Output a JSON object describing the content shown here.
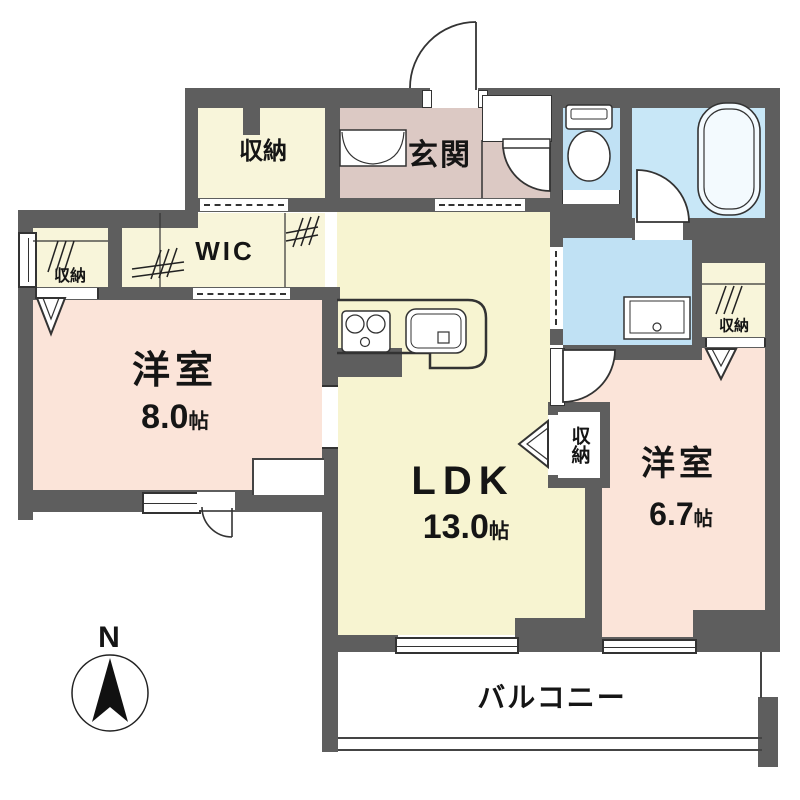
{
  "plan": {
    "type": "apartment-floor-plan",
    "rooms": {
      "closet_top": {
        "label": "収納"
      },
      "wic": {
        "label": "WIC"
      },
      "closet_left": {
        "label": "収納"
      },
      "western8": {
        "label": "洋室",
        "size": "8.0",
        "unit": "帖"
      },
      "genkan": {
        "label": "玄関"
      },
      "ldk": {
        "label": "LDK",
        "size": "13.0",
        "unit": "帖"
      },
      "closet_mid": {
        "label": "収納"
      },
      "western67": {
        "label": "洋室",
        "size": "6.7",
        "unit": "帖"
      },
      "closet_right": {
        "label": "収納"
      },
      "balcony": {
        "label": "バルコニー"
      }
    },
    "fixtures": [
      "toilet",
      "bathtub",
      "vanity",
      "stove",
      "kitchen-sink",
      "shoe-cabinet"
    ],
    "compass": {
      "north_label": "N"
    },
    "colors": {
      "wall": "#5e5e5e",
      "ldk_yellow": "#f7f4d1",
      "closet_cream": "#f8f5da",
      "room_pink": "#fbe4d9",
      "genkan_pink": "#dcc9c4",
      "wet_blue": "#c0e1f4",
      "bath_blue": "#c8e7f7",
      "line": "#333333"
    }
  }
}
